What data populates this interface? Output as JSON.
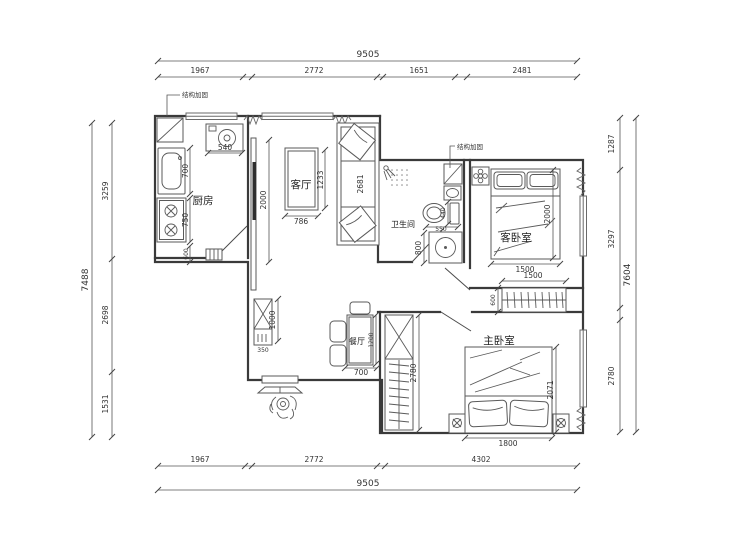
{
  "rooms": {
    "kitchen": "厨房",
    "living": "客厅",
    "dining": "餐厅",
    "bathroom": "卫生间",
    "guest_bedroom": "客卧室",
    "master_bedroom": "主卧室"
  },
  "annotations": {
    "kitchen_reinforce": "结构加固",
    "bath_reinforce": "结构加固"
  },
  "colors": {
    "wall": "#3a3a3a",
    "dimension": "#555555",
    "background": "#ffffff"
  },
  "dimensions": {
    "top": {
      "total": "9505",
      "s1": "1967",
      "s2": "2772",
      "s3": "1651",
      "s4": "2481"
    },
    "bottom": {
      "total": "9505",
      "s1": "1967",
      "s2": "2772",
      "s3": "4302"
    },
    "left": {
      "total": "7488",
      "s1": "3259",
      "s2": "2698",
      "s3": "1531"
    },
    "right": {
      "total": "7604",
      "s1": "1287",
      "s2": "3297",
      "s3": "2780"
    },
    "kitchen": {
      "washer": "540",
      "sink": "700",
      "stove": "750",
      "cabinet": "600"
    },
    "living": {
      "tv_wall": "2000",
      "table_w": "786",
      "table_h": "1233",
      "sofa": "2681"
    },
    "bathroom": {
      "toilet_h": "440",
      "toilet_w": "550",
      "washer": "800"
    },
    "guest": {
      "bed_w": "1500",
      "bed_h": "2000",
      "hall_closet_w": "1500",
      "closet_d": "600"
    },
    "master": {
      "bed_w": "1800",
      "bed_h": "2071",
      "wardrobe": "2780"
    },
    "dining": {
      "table_w": "700",
      "table_h": "1200"
    },
    "hall": {
      "shoe_cabinet_h": "1000",
      "shoe_cabinet_w": "350"
    }
  }
}
